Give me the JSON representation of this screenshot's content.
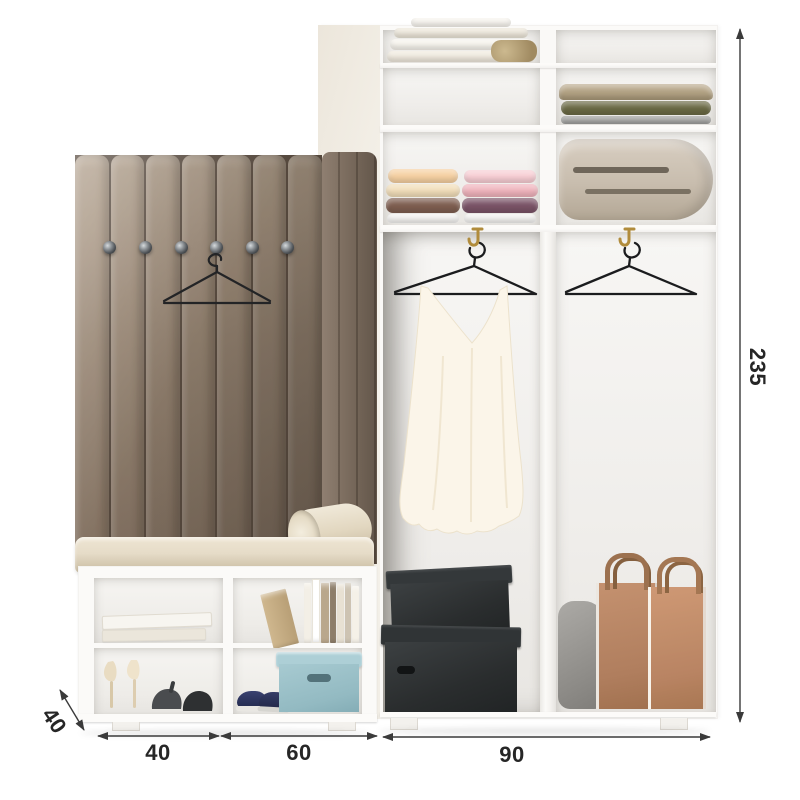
{
  "scene": {
    "type": "furniture-product-dimension-render",
    "description": "White hallway set: channel-tufted coat panel with hooks and shoe bench, plus open wardrobe with shelves, rails, boxes and bags, annotated with size arrows"
  },
  "dimensions": {
    "width_left": {
      "label": "40"
    },
    "width_mid": {
      "label": "60"
    },
    "width_right": {
      "label": "90"
    },
    "height": {
      "label": "235"
    },
    "depth": {
      "label": "40"
    }
  },
  "palette": {
    "background": "#ffffff",
    "dimension_line": "#3a3a3a",
    "dimension_text": "#262626",
    "upholstery": "#93816f",
    "upholstery_shadow": "#6b5c4d",
    "cushion_cream": "#e6dcc7",
    "cabinet_white": "#fbfaf8",
    "teal_box": "#a3c8cf",
    "dark_box": "#2d3031",
    "tan_bag": "#bd8a6c",
    "navy_sneaker": "#2c3259",
    "brass_hook": "#b18c3c",
    "hanger_wire": "#1b1c1e"
  },
  "contents": {
    "wardrobe_shelves": [
      "folded-linen-stack",
      "empty",
      "empty",
      "folded-blankets",
      "towel-stacks",
      "rolled-duvet"
    ],
    "wardrobe_rails": [
      "white-dress-on-hanger",
      "empty-hanger"
    ],
    "wardrobe_floor": [
      "two-black-storage-boxes",
      "grey-pouch-bag",
      "two-tan-carrier-bags"
    ],
    "bench_cubbies": [
      "flat-books",
      "row-of-books",
      "beige-heels-and-dark-heels",
      "navy-sneakers-and-teal-box"
    ],
    "coat_panel": [
      "six-round-hooks",
      "black-wire-hanger"
    ]
  }
}
